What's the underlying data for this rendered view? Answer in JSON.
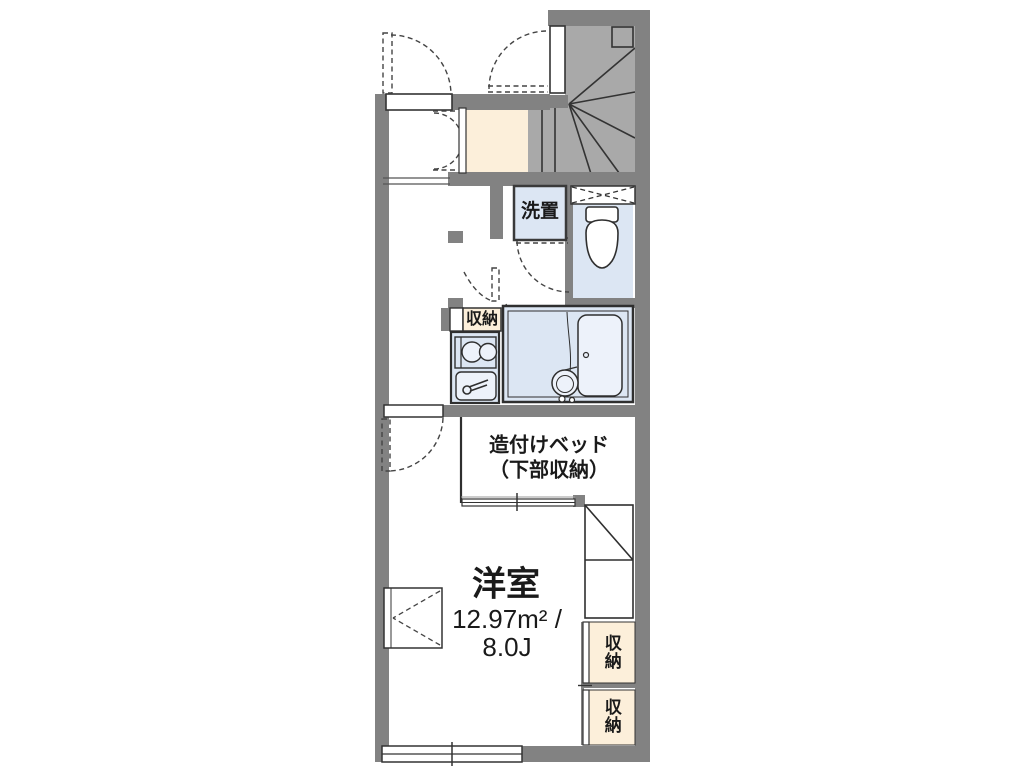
{
  "plan": {
    "labels": {
      "washer": "洗置",
      "kitchen_storage": "収納",
      "bed_line1": "造付けベッド",
      "bed_line2": "（下部収納）",
      "room_name": "洋室",
      "room_area": "12.97m² /",
      "room_size": "8.0J",
      "storage_upper": "収納",
      "storage_lower": "収納"
    },
    "colors": {
      "wall": "#828282",
      "stair_floor": "#a9a9a9",
      "entry_floor": "#fcefda",
      "storage_fill": "#fcefda",
      "wet_area_fill": "#dce6f3",
      "fixture_fill": "#edf2fa",
      "outline": "#333333"
    }
  }
}
